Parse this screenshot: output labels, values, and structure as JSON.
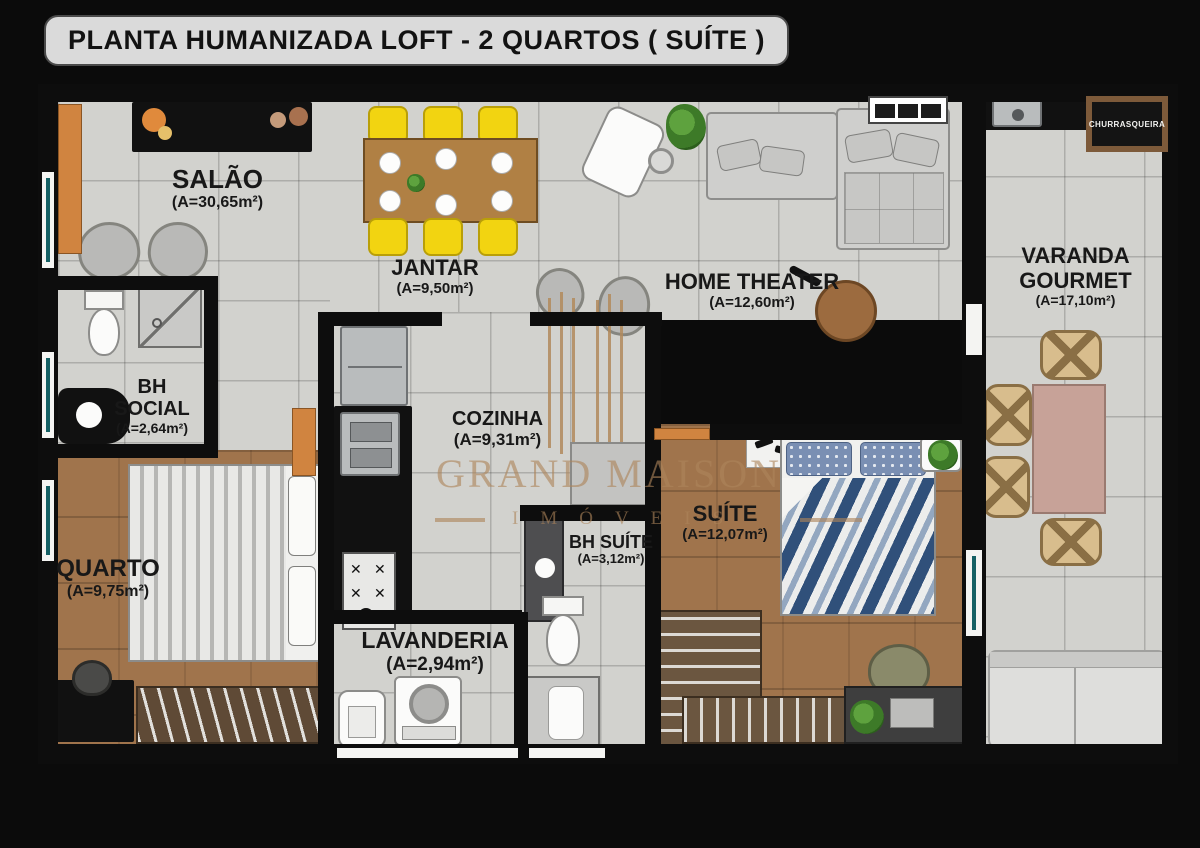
{
  "title": "PLANTA HUMANIZADA LOFT - 2 QUARTOS ( SUÍTE )",
  "watermark": {
    "line1": "GRAND MAISON",
    "line2": "IMÓVEIS"
  },
  "signs": {
    "churrasqueira": "CHURRASQUEIRA"
  },
  "rooms": {
    "salao": {
      "name": "SALÃO",
      "area": "(A=30,65m²)"
    },
    "jantar": {
      "name": "JANTAR",
      "area": "(A=9,50m²)"
    },
    "home_theater": {
      "name": "HOME THEATER",
      "area": "(A=12,60m²)"
    },
    "varanda": {
      "name": "VARANDA GOURMET",
      "area": "(A=17,10m²)"
    },
    "bh_social": {
      "name": "BH SOCIAL",
      "area": "(A=2,64m²)"
    },
    "cozinha": {
      "name": "COZINHA",
      "area": "(A=9,31m²)"
    },
    "quarto": {
      "name": "QUARTO",
      "area": "(A=9,75m²)"
    },
    "lavanderia": {
      "name": "LAVANDERIA",
      "area": "(A=2,94m²)"
    },
    "bh_suite": {
      "name": "BH SUÍTE",
      "area": "(A=3,12m²)"
    },
    "suite": {
      "name": "SUÍTE",
      "area": "(A=12,07m²)"
    }
  },
  "colors": {
    "wall": "#0d0d0d",
    "tile_floor": "#d2d2ce",
    "wood_floor": "#a0744c",
    "accent_yellow": "#f2d411",
    "accent_orange": "#d08440",
    "watermark_tan": "#ad845a",
    "window_teal": "#156064",
    "suite_bed_blue": "#30507a"
  }
}
